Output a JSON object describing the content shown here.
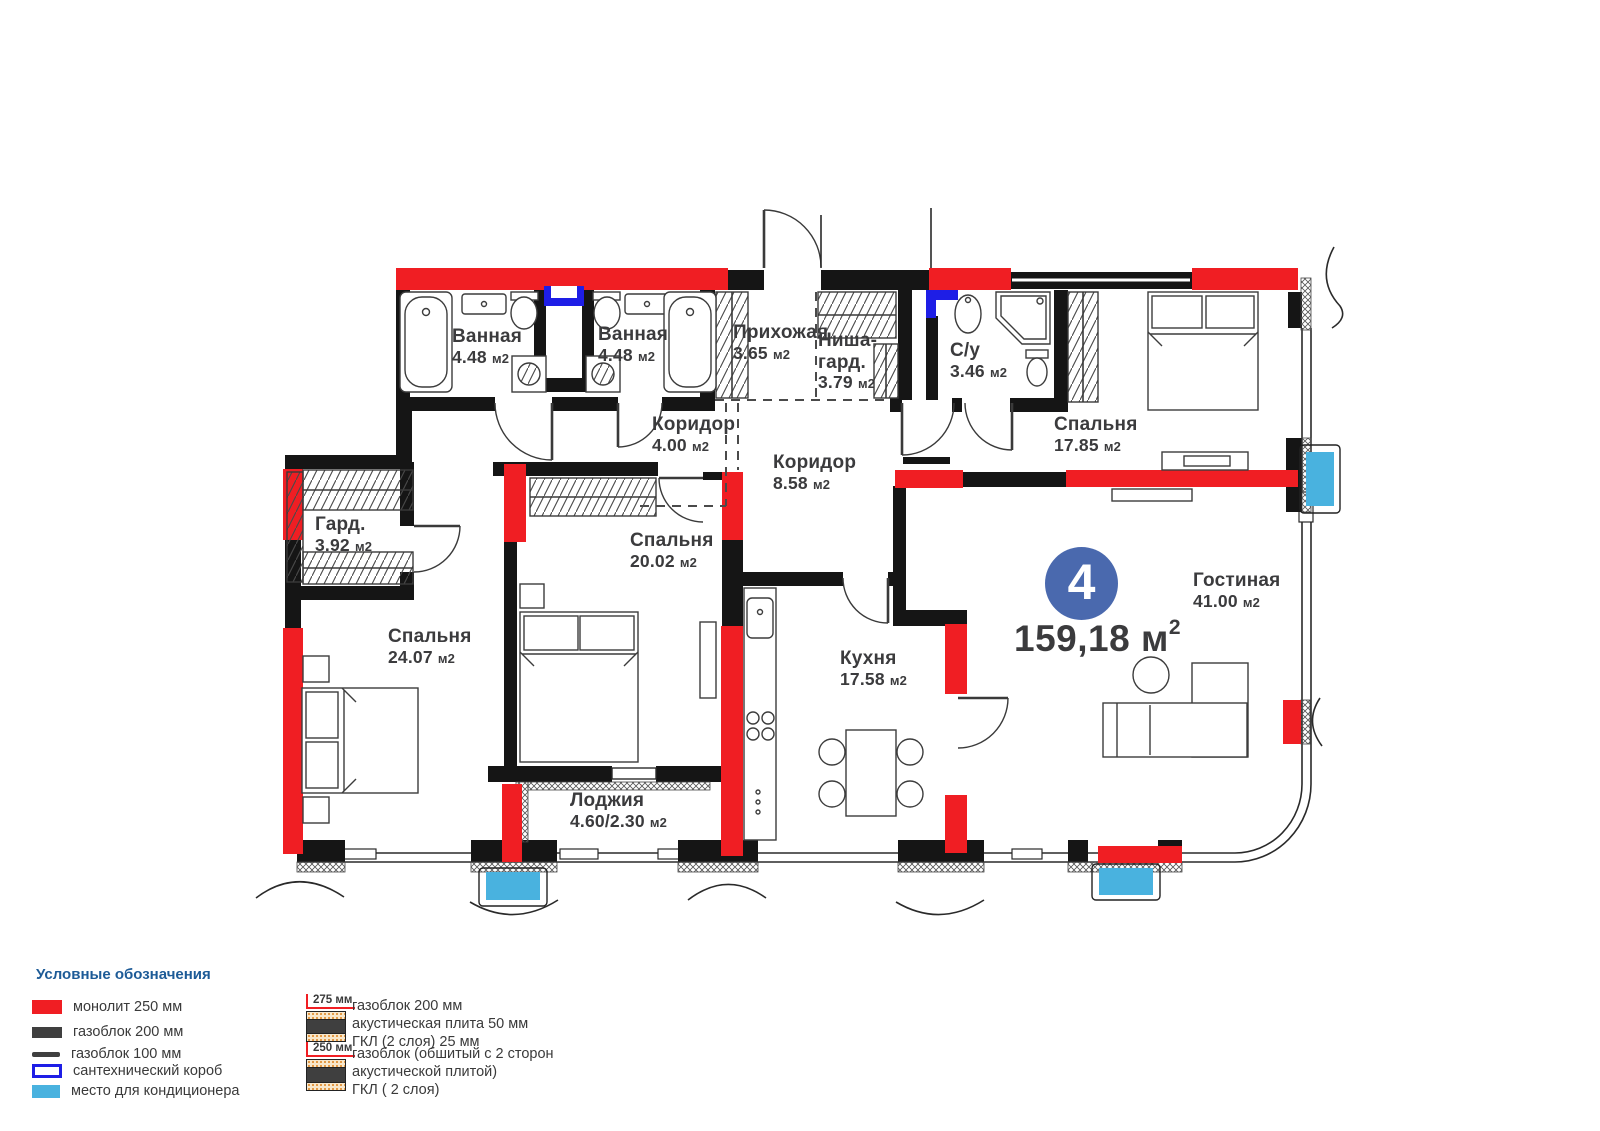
{
  "plan": {
    "badge": {
      "number": "4"
    },
    "total_area": {
      "value": "159,18",
      "unit": "м",
      "sup": "2"
    },
    "rooms": [
      {
        "name": "Ванная",
        "area": "4.48",
        "unit": "м2"
      },
      {
        "name": "Ванная",
        "area": "4.48",
        "unit": "м2"
      },
      {
        "name": "Прихожая",
        "area": "3.65",
        "unit": "м2"
      },
      {
        "name": "Ниша-гард.",
        "area": "3.79",
        "unit": "м2"
      },
      {
        "name": "С/у",
        "area": "3.46",
        "unit": "м2"
      },
      {
        "name": "Спальня",
        "area": "17.85",
        "unit": "м2"
      },
      {
        "name": "Коридор",
        "area": "4.00",
        "unit": "м2"
      },
      {
        "name": "Коридор",
        "area": "8.58",
        "unit": "м2"
      },
      {
        "name": "Гард.",
        "area": "3.92",
        "unit": "м2"
      },
      {
        "name": "Спальня",
        "area": "20.02",
        "unit": "м2"
      },
      {
        "name": "Спальня",
        "area": "24.07",
        "unit": "м2"
      },
      {
        "name": "Кухня",
        "area": "17.58",
        "unit": "м2"
      },
      {
        "name": "Лоджия",
        "area": "4.60/2.30",
        "unit": "м2"
      },
      {
        "name": "Гостиная",
        "area": "41.00",
        "unit": "м2"
      }
    ]
  },
  "legend": {
    "title": "Условные обозначения",
    "items": [
      {
        "label": "монолит 250 мм"
      },
      {
        "label": "газоблок 200 мм"
      },
      {
        "label": "газоблок 100 мм"
      },
      {
        "label": "сантехнический короб"
      },
      {
        "label": "место для кондиционера"
      }
    ],
    "assemblies": [
      {
        "dimension": "275 мм",
        "lines": [
          "газоблок 200 мм",
          "акустическая плита 50 мм",
          "ГКЛ (2 слоя) 25 мм"
        ]
      },
      {
        "dimension": "250 мм",
        "lines": [
          "газоблок (обшитый с 2 сторон",
          "акустической плитой)",
          "ГКЛ ( 2 слоя)"
        ]
      }
    ]
  },
  "colors": {
    "monolith": "#f01e23",
    "gasblock": "#151515",
    "plumbing_box": "#1e1ee6",
    "ac_spot": "#49b2df",
    "badge": "#4a69ae",
    "legend_heading": "#1d5b97"
  }
}
